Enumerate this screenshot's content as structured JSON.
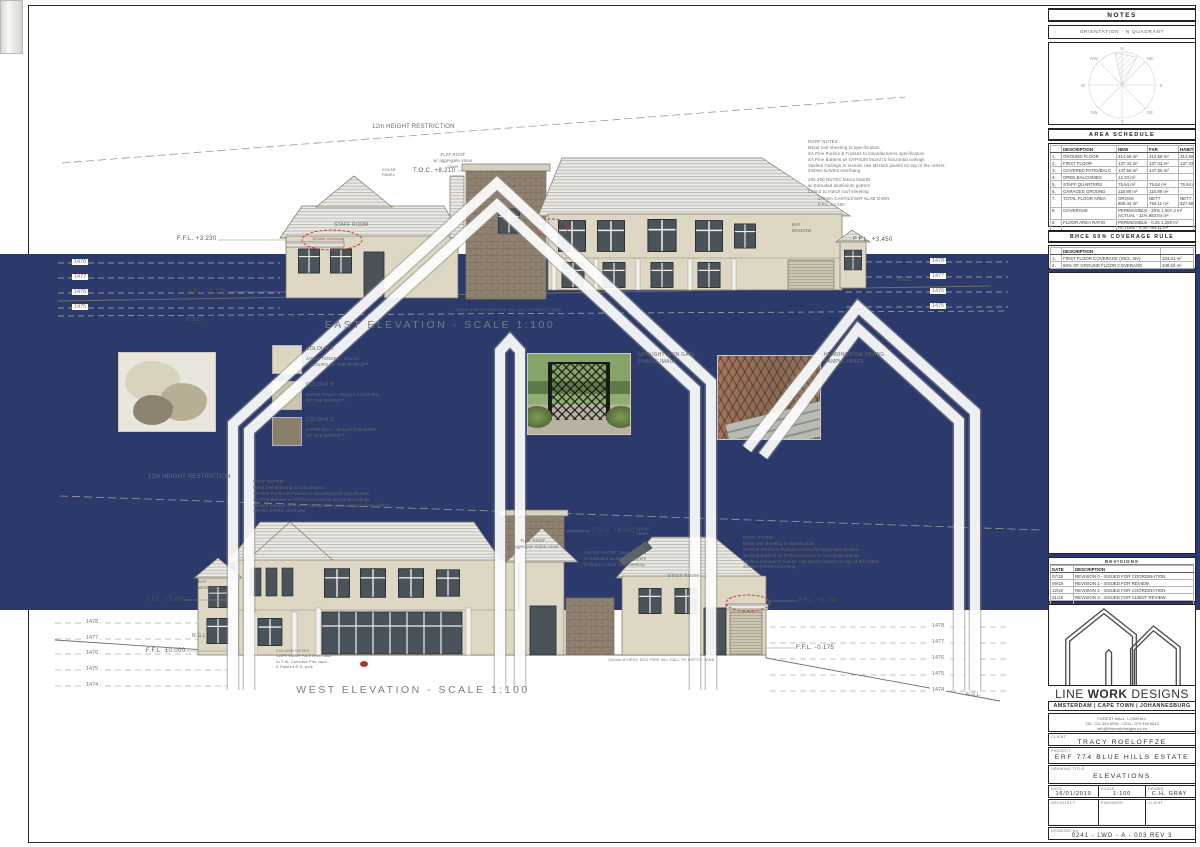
{
  "titles": {
    "east": "EAST ELEVATION - SCALE 1:100",
    "west": "WEST ELEVATION - SCALE 1:100"
  },
  "annotations": {
    "height_restriction": "12m HEIGHT RESTRICTION",
    "ngl": "N.G.L.",
    "toc": "T.O.C. +8.210",
    "staff_room": "STAFF ROOM",
    "overhang_note": "100mm overhang",
    "sewer_note": "110mm Ø UPVC SOIL PIPE min. FALL TO SEPTIC TANK",
    "roof_notes": {
      "title": "ROOF NOTES:",
      "lines": [
        "Metal roof sheeting to specification",
        "SA Pine Purlins & Trusses to manufacturers specification",
        "SA Pine Battens w/ GYPSUM board to horizontal ceilings",
        "Vaulted Ceilings to receive raw Meranti planks on top of the rafters",
        "400mm EAVES Overhang"
      ]
    },
    "fascia_lines": [
      "230-300 NUTEC fascia boards",
      "w/ Extruded aluminium gutters",
      "Colour to match roof sheeting"
    ],
    "cantilever_lines": [
      "170mm CANTILEVER SLAB OVER",
      "F.F.L. +3.450"
    ],
    "flat_roof_lines": [
      "FLAT ROOF",
      "w/ aggregate stone cover"
    ],
    "solar_lines": [
      "SOLAR",
      "PANEL"
    ],
    "bay_window_lines": [
      "BAY",
      "WINDOW"
    ],
    "column_notes_lines": [
      "COLUMN NOTES:",
      "CAPE WASH Face brick base",
      "w/ F.W. Concrete Pier caps",
      "& Painted R.S. pole"
    ],
    "east": {
      "ffl_left": "F.F.L. +3.230",
      "ffl_right": "F.F.L. +3.450",
      "ffl_base": "F.F.L. -0.170",
      "contours": [
        "1478",
        "1477",
        "1476",
        "1475"
      ]
    },
    "west": {
      "ffl_left": "F.F.L. +3.450",
      "ffl_zero": "F.F.L. ±0.000",
      "ffl_right": "F.F.L. +3.230",
      "ffl_base": "F.F.L. -0.175",
      "contours": [
        "1478",
        "1477",
        "1476",
        "1475",
        "1474"
      ]
    }
  },
  "legend": {
    "colour_a_label": "COLOUR A",
    "colour_a_desc_1": "JAPAN TENDER - DULUX",
    "colour_a_desc_2": "COLOURS OF THE WORLD™",
    "colour_b_label": "COLOUR B",
    "colour_b_desc_1": "JAPAN TRULY - DULUX COLOURS",
    "colour_b_desc_2": "OF THE WORLD™",
    "colour_c_label": "COLOUR C",
    "colour_c_desc_1": "JAPAN RICH - DULUX COLOURS",
    "colour_c_desc_2": "OF THE WORLD™",
    "swatch_a_style": "background:#ddd6c1",
    "swatch_b_style": "background:#ccc5ad",
    "swatch_c_style": "background:#8b7f6c",
    "gate_label_1": "WROUGHT IRON GATE",
    "gate_label_2": "SAMPLE IMAGE",
    "paving_label_1": "HERRINGBONE PAVING",
    "paving_label_2": "SAMPLE IMAGE"
  },
  "notes_panel": {
    "title": "NOTES",
    "orientation": "ORIENTATION - N QUADRANT",
    "compass_labels": [
      "N",
      "NE",
      "E",
      "SE",
      "S",
      "SW",
      "W",
      "NW"
    ]
  },
  "area_schedule": {
    "title": "AREA SCHEDULE",
    "col_desc": "DESCRIPTION",
    "col_new": "NEW",
    "col_far": "FAR",
    "col_hab": "HABITABLE",
    "rows": [
      {
        "no": "1.",
        "desc": "GROUND FLOOR",
        "new": "314.58 m²",
        "far": "314.58 m²",
        "hab": "314.58 m²"
      },
      {
        "no": "2.",
        "desc": "FIRST FLOOR",
        "new": "137.43 m²",
        "far": "137.43 m²",
        "hab": "137.43 m²"
      },
      {
        "no": "3.",
        "desc": "COVERED PATIO/BALC",
        "new": "147.56 m²",
        "far": "147.56 m²",
        "hab": ""
      },
      {
        "no": "4.",
        "desc": "OPEN BALCONIES",
        "new": "12.33 m²",
        "far": "",
        "hab": ""
      },
      {
        "no": "5.",
        "desc": "STAFF QUARTERS",
        "new": "75.64 m²",
        "far": "75.64 m²",
        "hab": "75.64 m²"
      },
      {
        "no": "6.",
        "desc": "GARAGES GROUND",
        "new": "118.89 m²",
        "far": "118.89 m²",
        "hab": ""
      },
      {
        "no": "7.",
        "desc": "TOTAL FLOOR AREA",
        "new": "GROSS",
        "new2": "806.44 m²",
        "far": "NETT",
        "far2": "794.11 m²",
        "hab": "NETT",
        "hab2": "527.66 m²"
      },
      {
        "no": "8.",
        "desc": "COVERAGE",
        "new": "PERMISSIBLE - 20% 1,007.2 m²",
        "new2": "ACTUAL - 11% 553.04 m²"
      },
      {
        "no": "9.",
        "desc": "FLOOR AREA RATIO",
        "new": "PERMISSIBLE - 0.25 1,259 m²",
        "new2": "ACTUAL - 0.16 794.11 m²"
      },
      {
        "no": "10.",
        "desc": "SITE AREA",
        "new": "5,036 m²"
      }
    ]
  },
  "coverage_rule": {
    "title": "BHCE 60% COVERAGE RULE",
    "col_desc": "DESCRIPTION",
    "rows": [
      {
        "no": "1.",
        "desc": "FIRST FLOOR COVERAGE (INCL. BV)",
        "value": "224.31 m²"
      },
      {
        "no": "2.",
        "desc": "60% OF GROUND FLOOR COVERAGE",
        "value": "348.62 m²"
      }
    ]
  },
  "revisions": {
    "title": "REVISIONS",
    "col_date": "DATE",
    "col_desc": "DESCRIPTION",
    "rows": [
      {
        "date": "07/18",
        "desc": "REVISION 0 - ISSUED FOR COORDINATION"
      },
      {
        "date": "09/18",
        "desc": "REVISION 1 - ISSUED FOR REVIEW"
      },
      {
        "date": "12/18",
        "desc": "REVISION 2 - ISSUED FOR COORDINATION"
      },
      {
        "date": "01/19",
        "desc": "REVISION 3 - ISSUED FOR CLIENT REVIEW"
      }
    ]
  },
  "title_block": {
    "brand_1": "LINE ",
    "brand_2": "WORK",
    "brand_3": " DESIGNS",
    "cities": "AMSTERDAM | CAPE TOWN | JOHANNESBURG",
    "address": "FOREST MALL, LONEHILL",
    "phone": "TEL: 011 463 6936   -   CELL: 079 495 6613",
    "email": "info@lineworkdesigns.co.za",
    "client_label": "CLIENT",
    "client": "TRACY ROELOFFZE",
    "project_label": "PROJECT",
    "project": "ERF 774 BLUE HILLS ESTATE",
    "drawing_title_label": "DRAWING TITLE",
    "drawing_title": "ELEVATIONS",
    "date_label": "DATE",
    "date": "16/01/2019",
    "scale_label": "SCALE",
    "scale": "1:100",
    "drawn_label": "DRAWN",
    "drawn": "C.H. GRAY",
    "architect_label": "ARCHITECT",
    "engineer_label": "ENGINEER",
    "client2_label": "CLIENT",
    "drawing_no_label": "DRAWING No.",
    "drawing_no": "0241 - LWD - A - 003 REV 3"
  }
}
